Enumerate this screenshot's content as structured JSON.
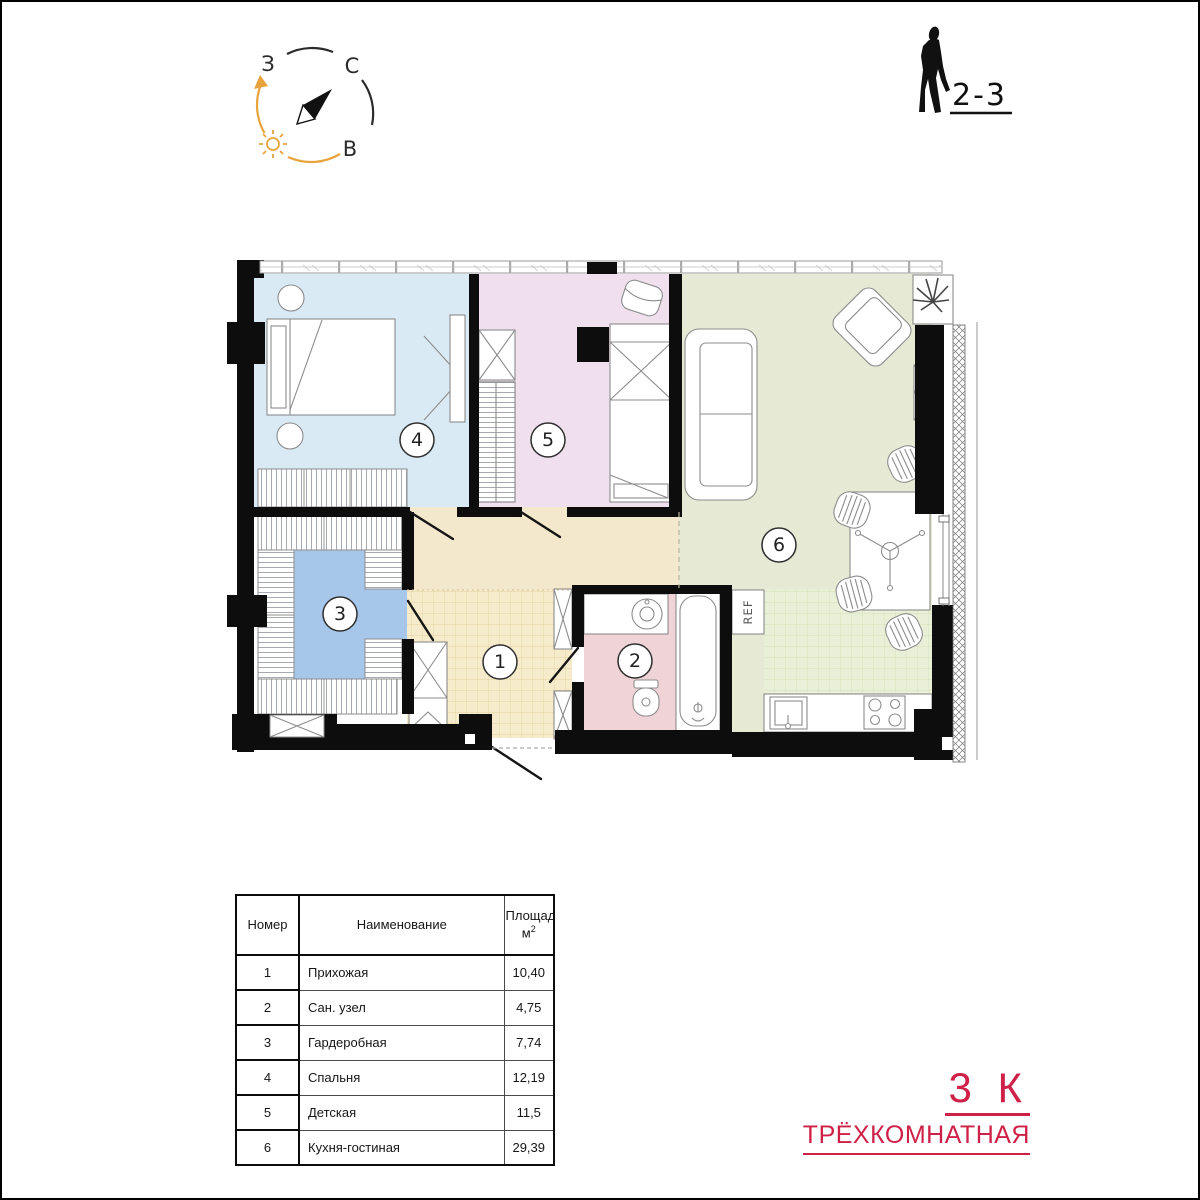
{
  "header": {
    "compass": {
      "west_label": "З",
      "north_label": "С",
      "east_label": "В",
      "sun_color": "#e8a33d"
    },
    "floor_range": "2-3"
  },
  "plan": {
    "room_badges": {
      "r1": "1",
      "r2": "2",
      "r3": "3",
      "r4": "4",
      "r5": "5",
      "r6": "6"
    },
    "fridge_label": "REF",
    "colors": {
      "bedroom": "#daeaf5",
      "children": "#f0e0ee",
      "living": "#e6e9d4",
      "kitchen_grid": "#eaf0d8",
      "wardrobe": "#a6c6ea",
      "corridor": "#f4e8cc",
      "hallway": "#f6ebca",
      "bathroom": "#f0d3d6",
      "wall": "#0d0d0d"
    }
  },
  "legend_table": {
    "headers": {
      "number": "Номер",
      "name": "Наименование",
      "area_line1": "Площадь,",
      "area_unit": "м",
      "area_sup": "2"
    },
    "rows": [
      {
        "number": "1",
        "name": "Прихожая",
        "area": "10,40"
      },
      {
        "number": "2",
        "name": "Сан. узел",
        "area": "4,75"
      },
      {
        "number": "3",
        "name": "Гардеробная",
        "area": "7,74"
      },
      {
        "number": "4",
        "name": "Спальня",
        "area": "12,19"
      },
      {
        "number": "5",
        "name": "Детская",
        "area": "11,5"
      },
      {
        "number": "6",
        "name": "Кухня-гостиная",
        "area": "29,39"
      }
    ]
  },
  "apartment_type": {
    "rooms_short": "3 К",
    "name": "ТРЁХКОМНАТНАЯ",
    "accent_color": "#cf2148"
  }
}
